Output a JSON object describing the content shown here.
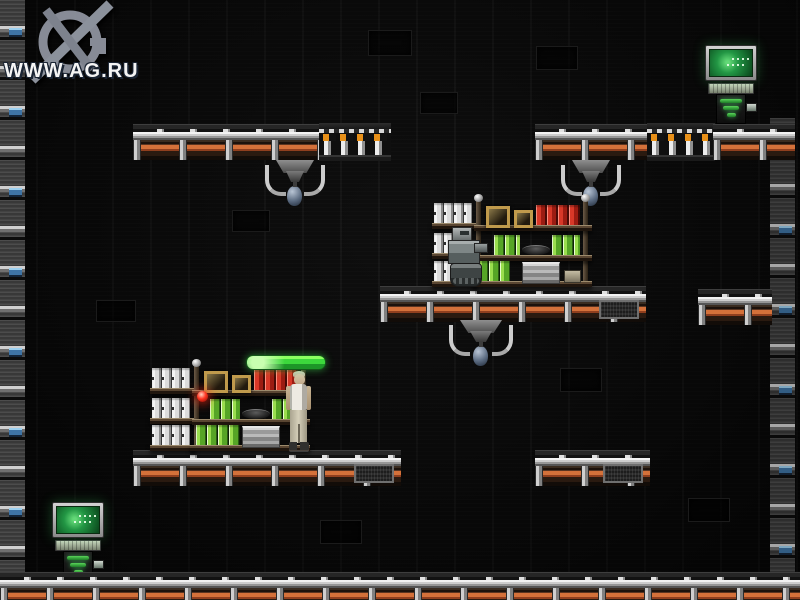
{
  "watermark": {
    "text": "WWW.AG.RU",
    "logo": "ag-ru-crosshair-logo"
  },
  "scene": {
    "setting": "dark industrial 2D platformer level",
    "player": {
      "name": "player-character",
      "appearance": "gray-haired man, white tank top, beige pants, standing beside storage shelf"
    },
    "objects": [
      {
        "name": "computer-terminal",
        "count": 2,
        "parts": [
          "green CRT monitor",
          "keyboard tray",
          "pedestal with green bars"
        ]
      },
      {
        "name": "ceiling-robot",
        "count": 3,
        "desc": "gray mount with curved claws and hanging blue orb"
      },
      {
        "name": "shelf-robot",
        "count": 1,
        "desc": "small gray tracked robot in front of upper shelf"
      },
      {
        "name": "storage-shelf",
        "count": 2,
        "contents": [
          "white binders",
          "green binders",
          "red binders",
          "gold picture frames",
          "dark disc",
          "metal crate",
          "small box"
        ]
      },
      {
        "name": "vent-platform",
        "count": 8
      },
      {
        "name": "ammo-rack-platform",
        "count": 2
      },
      {
        "name": "wall-machinery-strip",
        "count": 2
      }
    ],
    "indicators": {
      "status_bar": {
        "state": "full",
        "color": "#3cd83c"
      },
      "alert_light": {
        "color": "#ff3420"
      }
    }
  },
  "colors": {
    "background": "#090909",
    "vent_orange": "#d4713a",
    "rail_gray": "#cdcdcd",
    "screen_green": "#229644",
    "binder_green": "#9ade4e",
    "binder_red": "#d83828",
    "orb_blue": "#5a6a80"
  }
}
